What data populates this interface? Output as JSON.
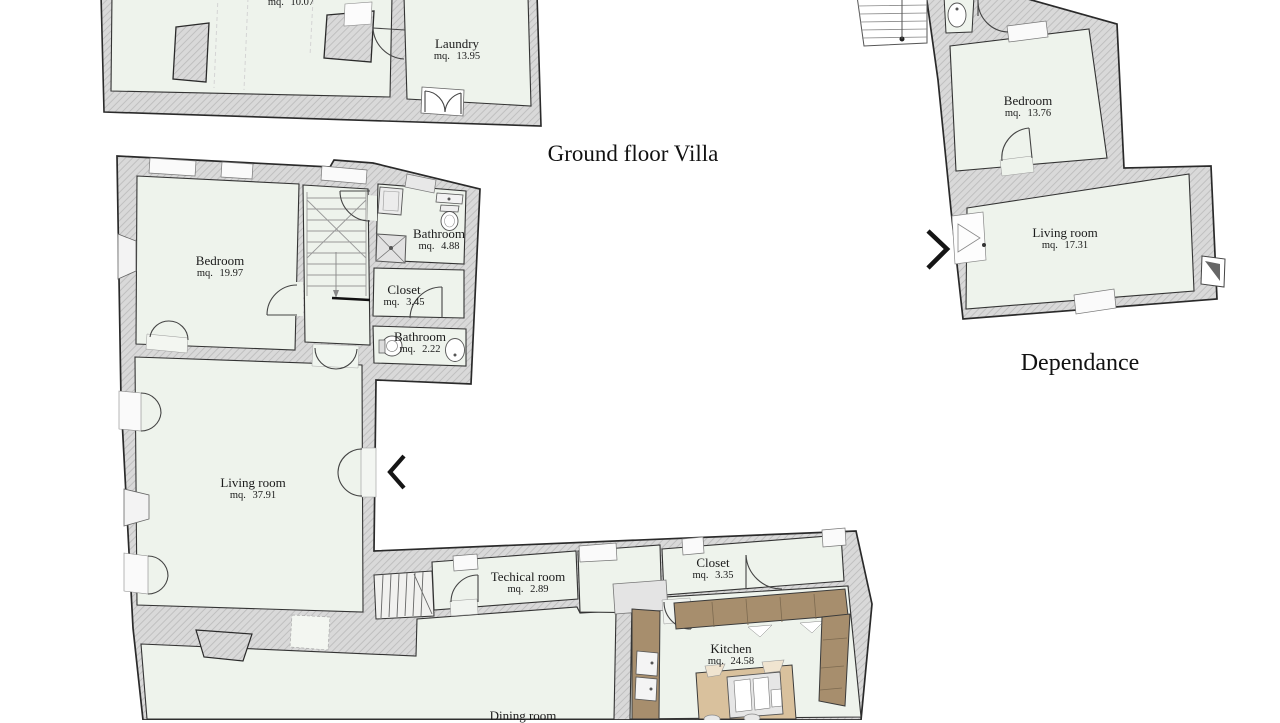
{
  "titles": {
    "villa": "Ground floor Villa",
    "dependance": "Dependance"
  },
  "rooms": {
    "upper": {
      "name": "",
      "area": "mq. 10.07"
    },
    "laundry": {
      "name": "Laundry",
      "area": "mq. 13.95"
    },
    "bedroom": {
      "name": "Bedroom",
      "area": "mq. 19.97"
    },
    "bathroom1": {
      "name": "Bathroom",
      "area": "mq. 4.88"
    },
    "closet1": {
      "name": "Closet",
      "area": "mq. 3.45"
    },
    "bathroom2": {
      "name": "Bathroom",
      "area": "mq. 2.22"
    },
    "living": {
      "name": "Living room",
      "area": "mq. 37.91"
    },
    "technical": {
      "name": "Techical room",
      "area": "mq. 2.89"
    },
    "closet2": {
      "name": "Closet",
      "area": "mq. 3.35"
    },
    "kitchen": {
      "name": "Kitchen",
      "area": "mq. 24.58"
    },
    "dining": {
      "name": "Dining room",
      "area": ""
    },
    "dep_bedroom": {
      "name": "Bedroom",
      "area": "mq. 13.76"
    },
    "dep_living": {
      "name": "Living room",
      "area": "mq. 17.31"
    }
  },
  "icons": {
    "left": "chevron-left",
    "right": "chevron-right"
  },
  "colors": {
    "wall_fill": "#d9d9d9",
    "wall_hatch": "#bdbdbd",
    "floor": "#eef3ec",
    "outline": "#2a2a2a",
    "counter_brown": "#a78e6d",
    "island_tan": "#d9c19d",
    "text": "#1c1c1c",
    "background": "#ffffff"
  }
}
